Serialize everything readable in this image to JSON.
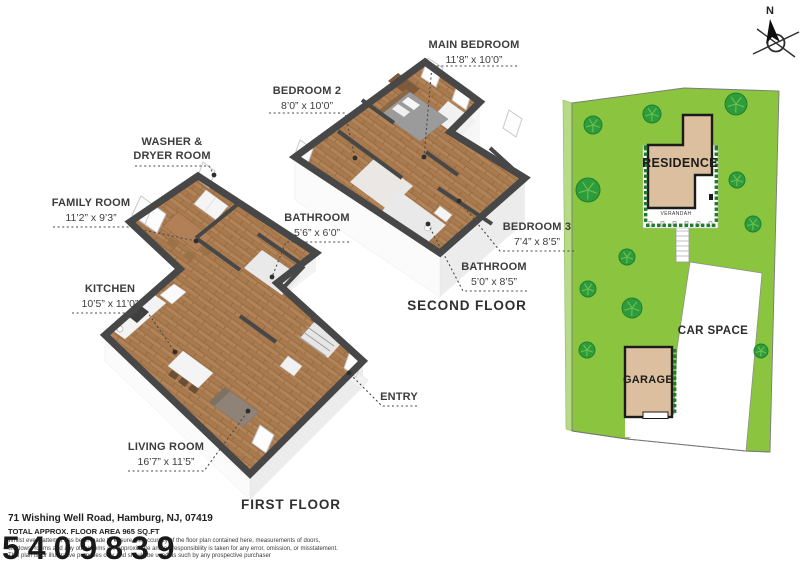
{
  "compass": {
    "label": "N"
  },
  "floors": [
    {
      "title": "FIRST FLOOR",
      "rooms": [
        {
          "id": "washer-dryer",
          "name": "WASHER &",
          "name2": "DRYER ROOM",
          "dims": ""
        },
        {
          "id": "family-room",
          "name": "FAMILY ROOM",
          "dims": "11’2” x 9’3”"
        },
        {
          "id": "kitchen",
          "name": "KITCHEN",
          "dims": "10’5” x 11’0”"
        },
        {
          "id": "bathroom",
          "name": "BATHROOM",
          "dims": "5’6” x 6’0”"
        },
        {
          "id": "living-room",
          "name": "LIVING ROOM",
          "dims": "16’7” x 11’5”"
        },
        {
          "id": "entry",
          "name": "ENTRY",
          "dims": ""
        }
      ]
    },
    {
      "title": "SECOND FLOOR",
      "rooms": [
        {
          "id": "main-bedroom",
          "name": "MAIN BEDROOM",
          "dims": "11’8” x 10’0”"
        },
        {
          "id": "bedroom-2",
          "name": "BEDROOM 2",
          "dims": "8’0” x 10’0”"
        },
        {
          "id": "bedroom-3",
          "name": "BEDROOM 3",
          "dims": "7’4” x 8’5”"
        },
        {
          "id": "bathroom-2",
          "name": "BATHROOM",
          "dims": "5’0” x 8’5”"
        }
      ]
    }
  ],
  "site_plan": {
    "residence": "RESIDENCE",
    "verandah": "VERANDAH",
    "garage": "GARAGE",
    "car_space": "CAR SPACE"
  },
  "footer": {
    "address": "71 Wishing Well Road, Hamburg, NJ, 07419",
    "area": "TOTAL APPROX. FLOOR AREA 965 SQ.FT",
    "disclaimer": [
      "Whilst every attempt has been made to ensure the accuracy of the floor plan contained here, measurements of doors,",
      "windows, rooms and any other items are approximate and no responsibility is taken for any error, omission, or misstatement.",
      "This plan is for illustrative purposes only and should be used as such by any prospective purchaser"
    ],
    "watermark": "5409839"
  },
  "colors": {
    "wall_dark": "#474747",
    "wood": "#b28357",
    "face_shade": "#ececec",
    "lawn": "#8bc53f",
    "lawn_light": "#b6db86",
    "tree": "#2e9c3b",
    "tree_edge": "#1f8130",
    "tree_vein": "#6cc153",
    "hedge": "#1e7c2a",
    "building_tan": "#dcbf9e",
    "leader": "#4a4a4a"
  }
}
